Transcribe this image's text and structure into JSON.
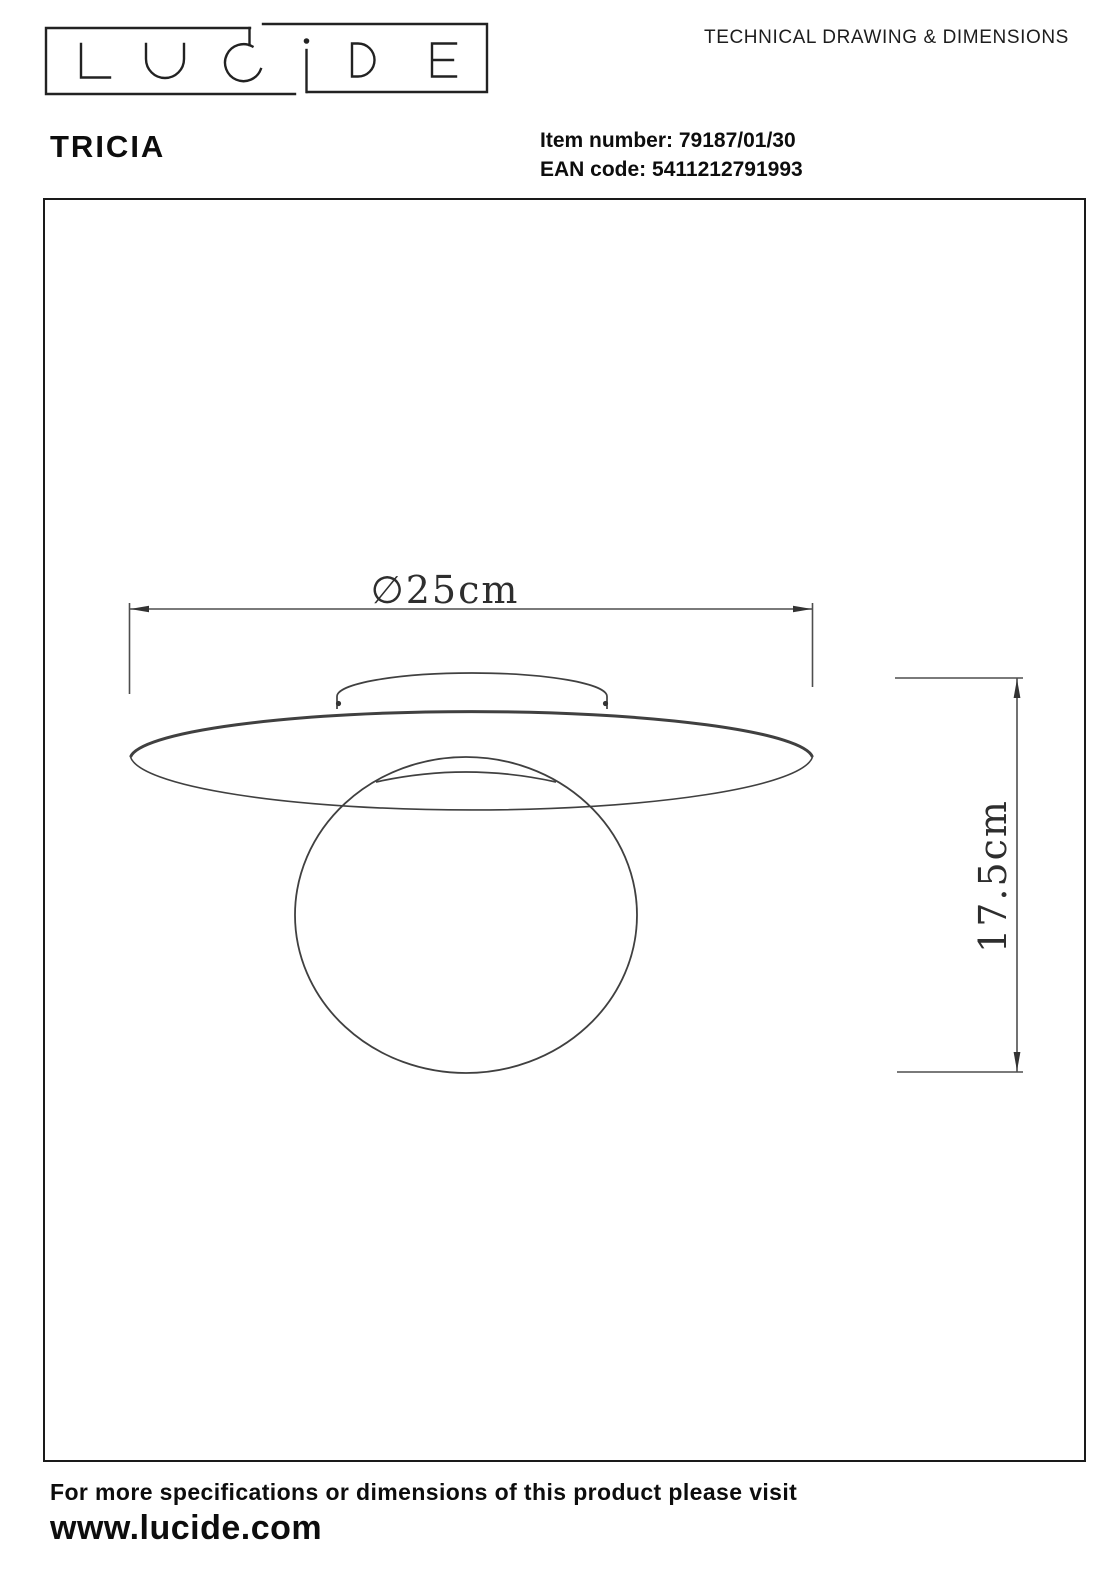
{
  "header": {
    "brand": "LUCIDE",
    "doc_title": "TECHNICAL DRAWING & DIMENSIONS"
  },
  "product": {
    "name": "TRICIA",
    "item_number_label": "Item number:",
    "item_number": "79187/01/30",
    "ean_label": "EAN code:",
    "ean_code": "5411212791993"
  },
  "drawing": {
    "diameter_label": "∅25cm",
    "height_label": "17.5cm"
  },
  "footer": {
    "line1": "For more specifications or dimensions of this product please visit",
    "line2": "www.lucide.com"
  },
  "colors": {
    "ink": "#111111",
    "drawing_line": "#404040",
    "dimension_line": "#4e4e4e"
  }
}
